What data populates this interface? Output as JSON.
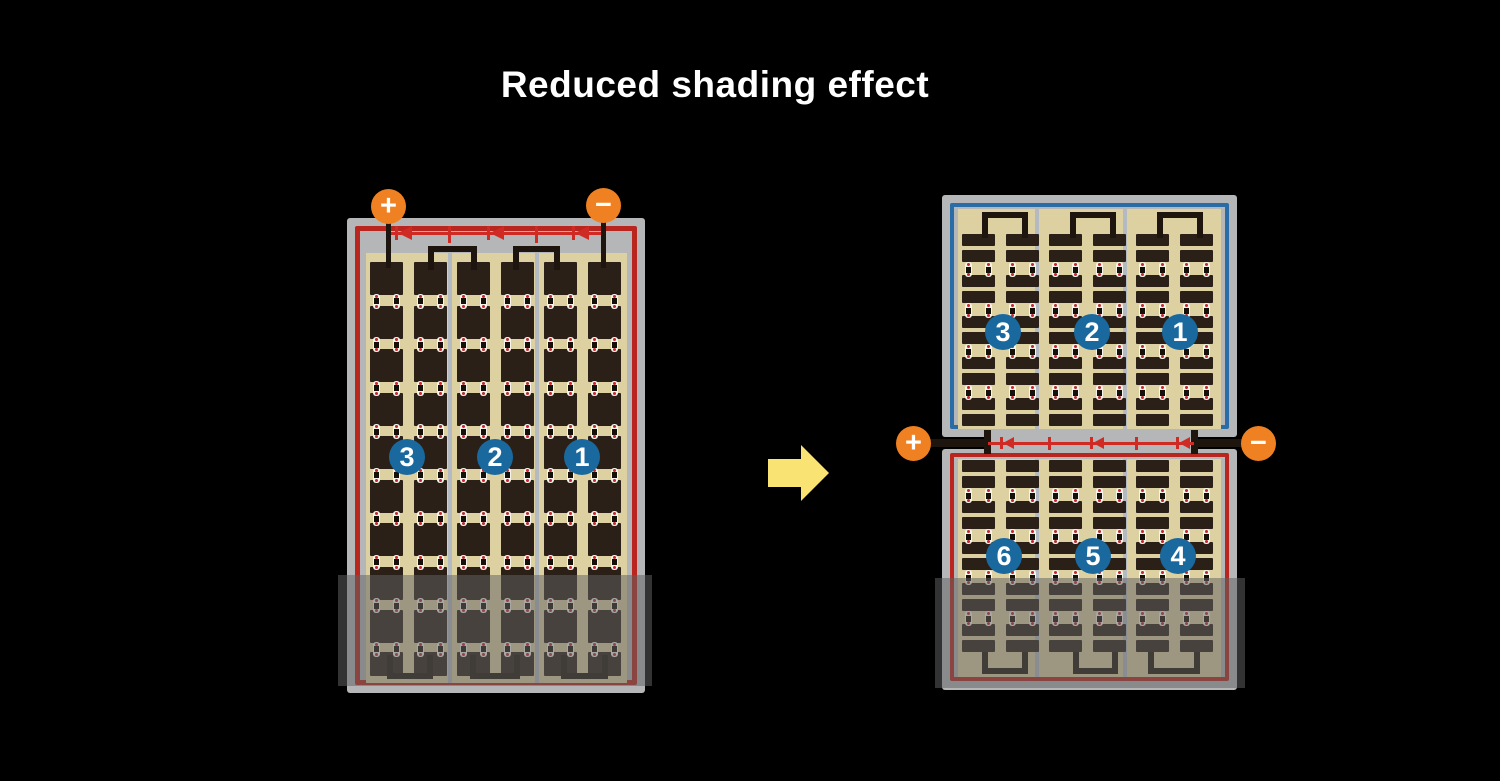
{
  "title": "Reduced shading effect",
  "colors": {
    "bg": "#000000",
    "title": "#ffffff",
    "orange": "#ef8122",
    "terminal-symbol": "#ffffff",
    "red": "#b9261f",
    "diode-red": "#cf2b24",
    "blue-border": "#2a6da6",
    "circle-blue": "#19699f",
    "circle-text": "#ffffff",
    "tan": "#ddd0a1",
    "cell": "#2a2018",
    "frame": "#b5b6b8",
    "divider": "#b3bac2",
    "wire": "#1d150e",
    "pill": "#f6f3ea",
    "pill-dot": "#c1272d",
    "pill-core": "#16100b",
    "yellow": "#f9e372",
    "overlay": "rgba(98,98,98,0.52)"
  },
  "left_panel": {
    "terminals": [
      {
        "symbol": "+"
      },
      {
        "symbol": "−"
      }
    ],
    "strings": [
      {
        "label": "3"
      },
      {
        "label": "2"
      },
      {
        "label": "1"
      }
    ],
    "columns": 6,
    "rows": 10,
    "bypass_diodes": 3,
    "shaded_rows": 2
  },
  "arrow": {
    "direction": "right"
  },
  "right_panel": {
    "terminals": [
      {
        "symbol": "+"
      },
      {
        "symbol": "−"
      }
    ],
    "top_half": {
      "strings": [
        {
          "label": "3"
        },
        {
          "label": "2"
        },
        {
          "label": "1"
        }
      ],
      "columns": 6,
      "rows": 10
    },
    "bottom_half": {
      "strings": [
        {
          "label": "6"
        },
        {
          "label": "5"
        },
        {
          "label": "4"
        }
      ],
      "columns": 6,
      "rows": 10
    },
    "bypass_diodes": 3,
    "shaded_rows": 3
  }
}
